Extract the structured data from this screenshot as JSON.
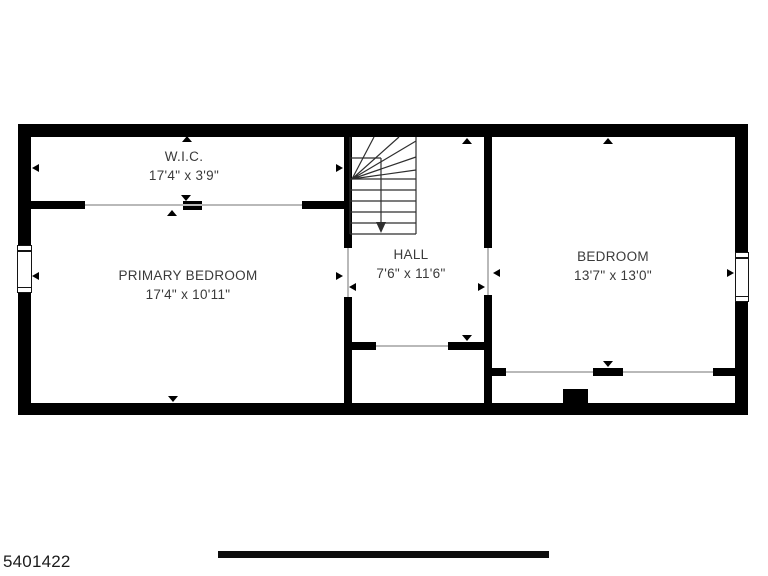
{
  "palette": {
    "background": "#ffffff",
    "wall": "#000000",
    "label_text": "#3a3a3a",
    "stair_line": "#2f2f2f"
  },
  "rooms": [
    {
      "name": "W.I.C.",
      "dimensions": "17'4\" x 3'9\""
    },
    {
      "name": "PRIMARY BEDROOM",
      "dimensions": "17'4\" x 10'11\""
    },
    {
      "name": "HALL",
      "dimensions": "7'6\" x 11'6\""
    },
    {
      "name": "BEDROOM",
      "dimensions": "13'7\" x 13'0\""
    }
  ],
  "footer": {
    "listing_id": "5401422"
  }
}
